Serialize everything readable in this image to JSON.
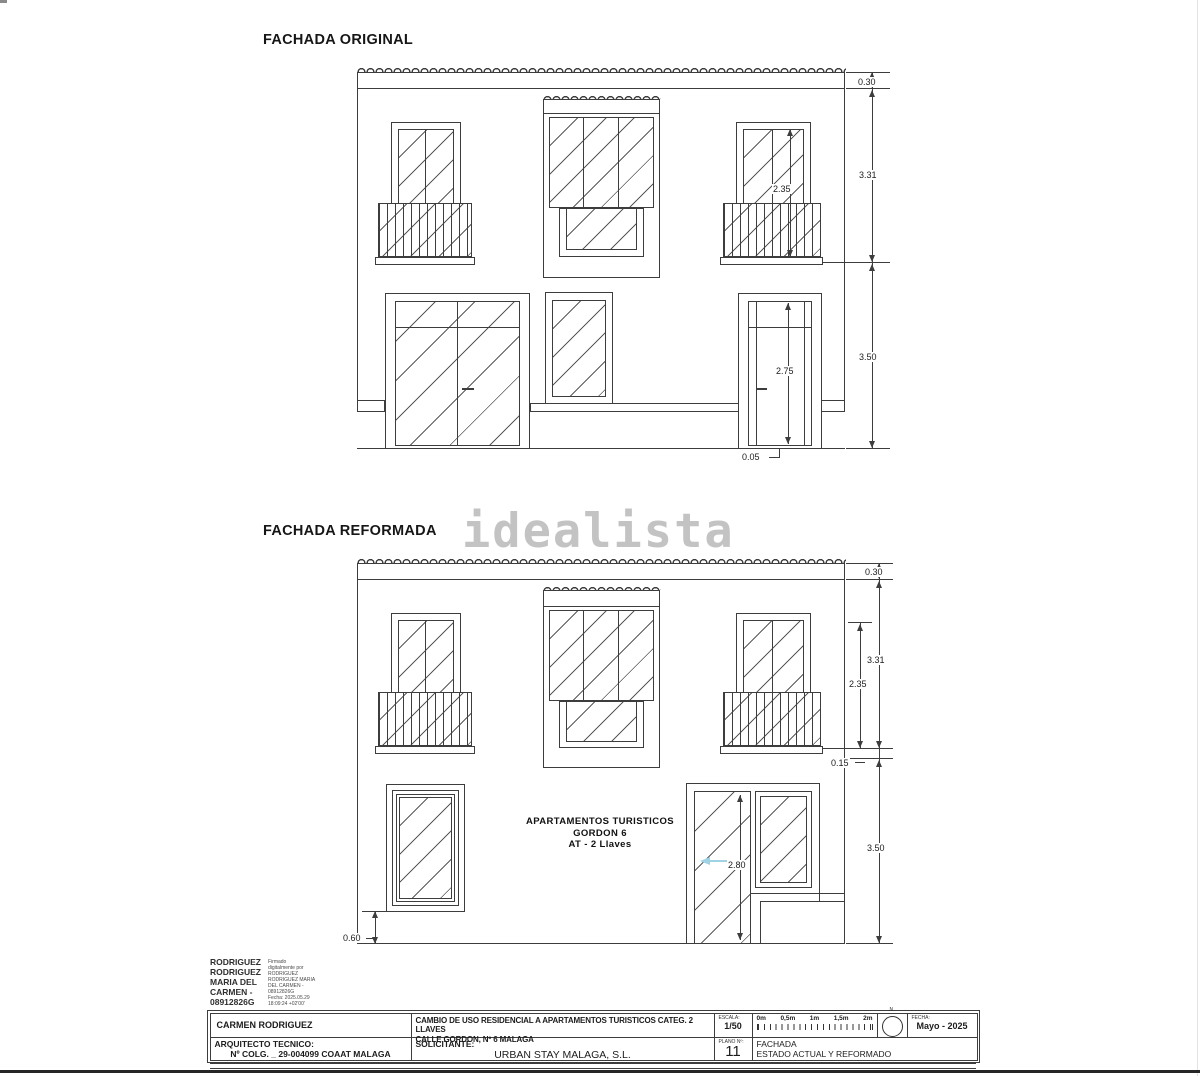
{
  "watermark": "idealista",
  "original": {
    "title": "FACHADA ORIGINAL",
    "dims": {
      "cornice": "0.30",
      "upper_floor": "3.31",
      "balcony_window": "2.35",
      "ground_floor": "3.50",
      "door": "2.75",
      "threshold": "0.05"
    }
  },
  "reformed": {
    "title": "FACHADA REFORMADA",
    "dims": {
      "cornice": "0.30",
      "upper_floor": "3.31",
      "balcony_window": "2.35",
      "floor_gap": "0.15",
      "ground_floor": "3.50",
      "door": "2.80",
      "sill": "0.60"
    },
    "label": {
      "line1": "APARTAMENTOS TURISTICOS",
      "line2": "GORDON 6",
      "line3": "AT - 2 Llaves"
    }
  },
  "signature": {
    "name_lines": [
      "RODRIGUEZ",
      "RODRIGUEZ",
      "MARIA DEL",
      "CARMEN -",
      "08912826G"
    ],
    "stamp_lines": [
      "Firmado",
      "digitalmente por",
      "RODRIGUEZ",
      "RODRIGUEZ MARIA",
      "DEL CARMEN -",
      "08912826G",
      "Fecha: 2025.05.29",
      "18:09:24 +02'00'"
    ]
  },
  "titleblock": {
    "author": "CARMEN RODRIGUEZ",
    "project_line1": "CAMBIO DE USO RESIDENCIAL A APARTAMENTOS TURISTICOS CATEG. 2 LLAVES",
    "project_line2": "CALLE GORDON, Nº 6  MALAGA",
    "scale_label": "ESCALA:",
    "scale_value": "1/50",
    "scale_ticks": [
      "0m",
      "0,5m",
      "1m",
      "1,5m",
      "2m"
    ],
    "north_label": "N.",
    "date_label": "FECHA:",
    "date_value": "Mayo - 2025",
    "architect_label": "ARQUITECTO TECNICO:",
    "architect_value": "Nº COLG. _ 29-004099  COAAT MALAGA",
    "client_label": "SOLICITANTE:",
    "client_value": "URBAN STAY MALAGA, S.L.",
    "sheet_label": "PLANO Nº:",
    "sheet_number": "11",
    "sheet_title1": "FACHADA",
    "sheet_title2": "ESTADO ACTUAL Y REFORMADO"
  }
}
